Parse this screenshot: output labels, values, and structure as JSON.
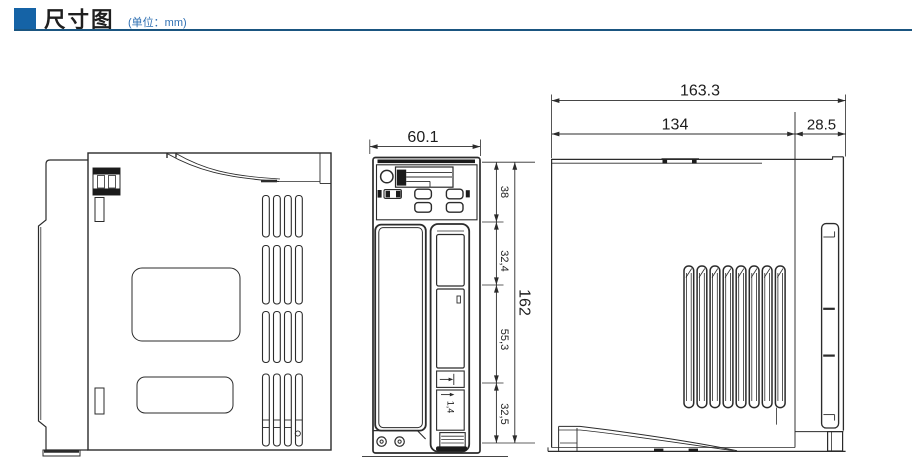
{
  "header": {
    "title": "尺寸图",
    "unit_note": "(单位：mm)",
    "accent_color": "#1563a6",
    "rule_color": "#1a5580"
  },
  "dimensions": {
    "front_view": {
      "width": "60.1",
      "segment_top": "38",
      "segment_upper": "32,4",
      "segment_middle": "55,3",
      "segment_bottom": "32,5",
      "overall_height": "162",
      "slot_thickness": "1,4"
    },
    "side_view": {
      "overall_width": "163.3",
      "body_width": "134",
      "front_width": "28.5"
    }
  }
}
